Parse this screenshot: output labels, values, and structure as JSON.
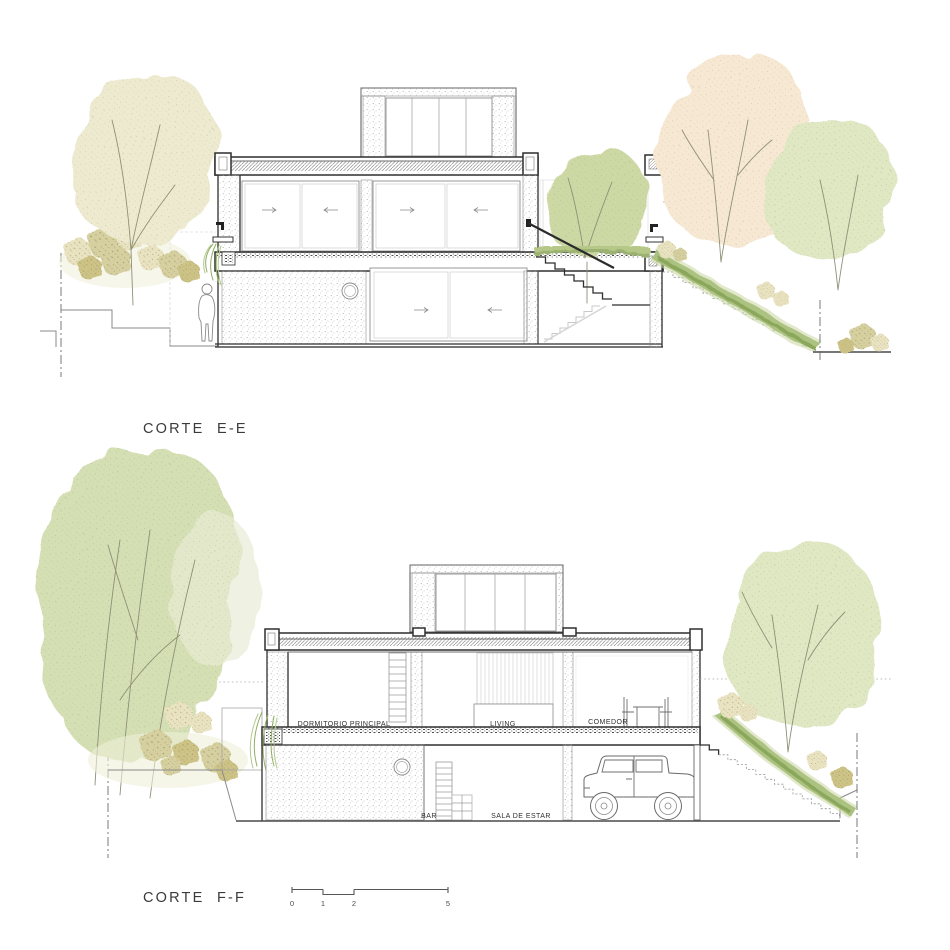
{
  "titles": {
    "section_e": "CORTE  E-E",
    "section_f": "CORTE  F-F"
  },
  "rooms": {
    "dormitorio": "DORMITORIO PRINCIPAL",
    "living": "LIVING",
    "comedor": "COMEDOR",
    "bar": "BAR",
    "sala": "SALA DE ESTAR"
  },
  "scale_bar": {
    "ticks": [
      "0",
      "1",
      "2",
      "5"
    ]
  },
  "colors": {
    "line_dark": "#2f2f2f",
    "line_mid": "#8a8a8a",
    "tree_pale": "#edead0",
    "tree_green": "#d5dfb4",
    "tree_green_light": "#dfe7c3",
    "tree_peach": "#f6e8d2",
    "courtyard_tree": "#cdd9a5",
    "slope_vegetation": "#a9c07c",
    "slope_vegetation_dark": "#8ba75c",
    "bush_tan": "#e9e3c1",
    "bush_olive": "#d6d0a0",
    "plant_green": "#8fae62"
  }
}
